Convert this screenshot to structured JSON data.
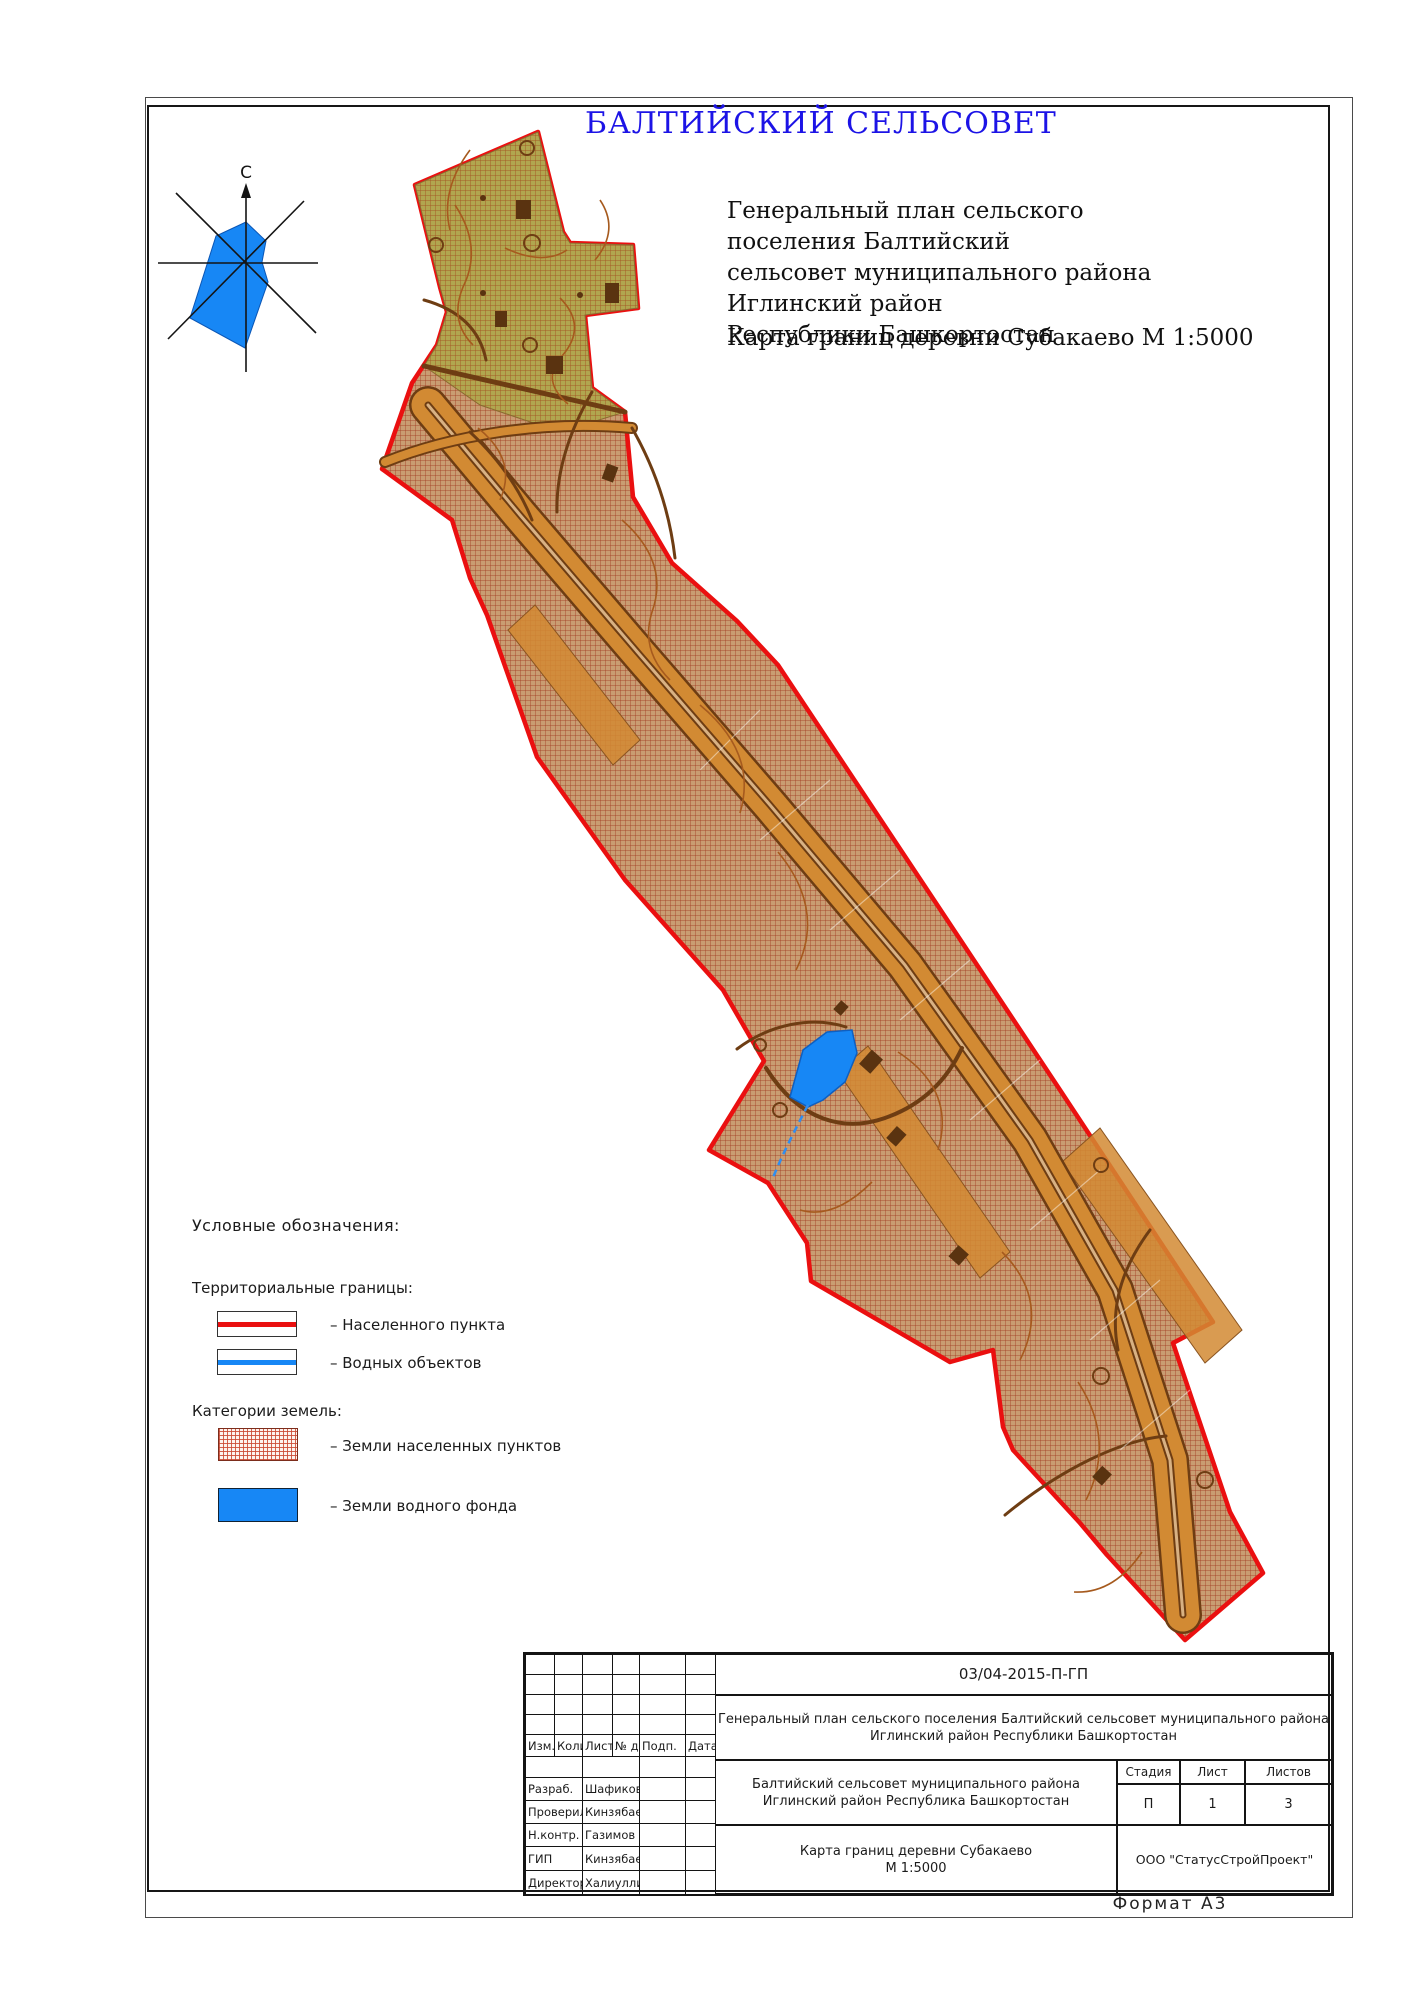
{
  "page": {
    "format_label": "Формат А3"
  },
  "header": {
    "title": "БАЛТИЙСКИЙ СЕЛЬСОВЕТ",
    "subtitle_line1": "Генеральный план сельского поселения Балтийский",
    "subtitle_line2": "сельсовет муниципального района Иглинский район",
    "subtitle_line3": "Республики Башкортостан",
    "map_caption": "Карта границ деревни Субакаево М 1:5000"
  },
  "compass": {
    "north_label": "С"
  },
  "legend": {
    "heading": "Условные обозначения:",
    "territorial_heading": "Территориальные границы:",
    "items": {
      "settlement_boundary": "– Населенного пункта",
      "water_boundary": "– Водных объектов"
    },
    "categories_heading": "Категории земель:",
    "categories": {
      "settlement_lands": "– Земли населенных пунктов",
      "water_fund_lands": "– Земли водного фонда"
    }
  },
  "title_block": {
    "doc_number": "03/04-2015-П-ГП",
    "project_name_line1": "Генеральный план сельского поселения Балтийский сельсовет муниципального района",
    "project_name_line2": "Иглинский район Республики Башкортостан",
    "object_line1": "Балтийский сельсовет муниципального района",
    "object_line2": "Иглинский район Республика Башкортостан",
    "sheet_title_line1": "Карта границ деревни Субакаево",
    "sheet_title_line2": "М 1:5000",
    "company": "ООО \"СтатусСтройПроект\"",
    "stage_header": "Стадия",
    "sheet_header": "Лист",
    "sheets_header": "Листов",
    "stage_value": "П",
    "sheet_value": "1",
    "sheets_value": "3",
    "columns": [
      "Изм.",
      "Колич.",
      "Лист",
      "№ док",
      "Подп.",
      "Дата"
    ],
    "roles": [
      {
        "role": "Разраб.",
        "name": "Шафиков"
      },
      {
        "role": "Проверил",
        "name": "Кинзябаев"
      },
      {
        "role": "Н.контр.",
        "name": "Газимов"
      },
      {
        "role": "ГИП",
        "name": "Кинзябаев"
      },
      {
        "role": "Директор",
        "name": "Халиуллин"
      }
    ]
  },
  "colors": {
    "boundary_red": "#ea1010",
    "water_blue": "#1787f5",
    "land_tan": "#c99d72",
    "land_olive": "#b3a850",
    "road_orange": "#d28a33",
    "title_blue": "#1c13e6"
  }
}
